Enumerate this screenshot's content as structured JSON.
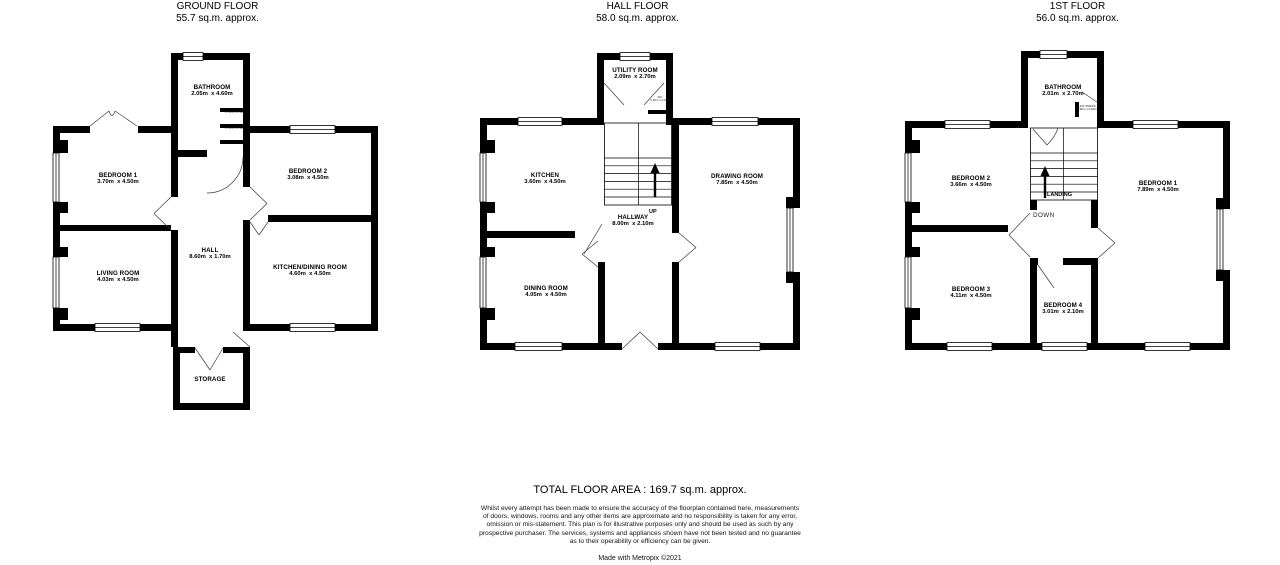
{
  "floors": {
    "ground": {
      "title": "GROUND FLOOR",
      "subtitle": "55.7 sq.m. approx.",
      "rooms": {
        "bathroom": {
          "name": "BATHROOM",
          "dims": "2.05m  x 4.60m"
        },
        "bedroom1": {
          "name": "BEDROOM 1",
          "dims": "3.70m  x 4.50m"
        },
        "bedroom2": {
          "name": "BEDROOM 2",
          "dims": "3.08m  x 4.50m"
        },
        "hall": {
          "name": "HALL",
          "dims": "8.60m  x 1.70m"
        },
        "living": {
          "name": "LIVING ROOM",
          "dims": "4.03m  x 4.50m"
        },
        "kitchen_dining": {
          "name": "KITCHEN/DINING ROOM",
          "dims": "4.60m  x 4.50m"
        },
        "storage": {
          "name": "STORAGE"
        }
      },
      "closet_labels": {
        "upper": "1.70m x 0.50m",
        "lower": "1.70m x 0.50m"
      }
    },
    "hall": {
      "title": "HALL FLOOR",
      "subtitle": "58.0 sq.m. approx.",
      "rooms": {
        "utility": {
          "name": "UTILITY ROOM",
          "dims": "2.09m  x 2.70m"
        },
        "kitchen": {
          "name": "KITCHEN",
          "dims": "3.60m  x 4.50m"
        },
        "drawing": {
          "name": "DRAWING ROOM",
          "dims": "7.85m  x 4.50m"
        },
        "hallway": {
          "name": "HALLWAY",
          "dims": "8.00m  x 2.10m"
        },
        "dining": {
          "name": "DINING ROOM",
          "dims": "4.05m  x 4.50m"
        }
      },
      "stair_up_label": "UP",
      "wc_label": {
        "name": "WC",
        "dims": "1.30m x 0.90m"
      }
    },
    "first": {
      "title": "1ST FLOOR",
      "subtitle": "56.0 sq.m. approx.",
      "rooms": {
        "bathroom": {
          "name": "BATHROOM",
          "dims": "2.01m  x 2.70m"
        },
        "bedroom2": {
          "name": "BEDROOM 2",
          "dims": "3.66m  x 4.50m"
        },
        "bedroom1": {
          "name": "BEDROOM 1",
          "dims": "7.89m  x 4.50m"
        },
        "bedroom3": {
          "name": "BEDROOM 3",
          "dims": "4.11m  x 4.50m"
        },
        "bedroom4": {
          "name": "BEDROOM 4",
          "dims": "3.01m  x 2.10m"
        }
      },
      "landing_label": "LANDING",
      "down_label": "DOWN",
      "press_label": {
        "name": "HOT PRESS",
        "dims": "0.90m x 0.80m"
      }
    }
  },
  "footer": {
    "total_area": "TOTAL FLOOR AREA : 169.7 sq.m. approx.",
    "disclaimer": "Whilst every attempt has been made to ensure the accuracy of the floorplan contained here, measurements\nof doors, windows, rooms and any other items are approximate and no responsibility is taken for any error,\nomission or mis-statement. This plan is for illustrative purposes only and should be used as such by any\nprospective purchaser. The services, systems and appliances shown have not been tested and no guarantee\nas to their operability or efficiency can be given.",
    "credit": "Made with Metropix ©2021"
  }
}
